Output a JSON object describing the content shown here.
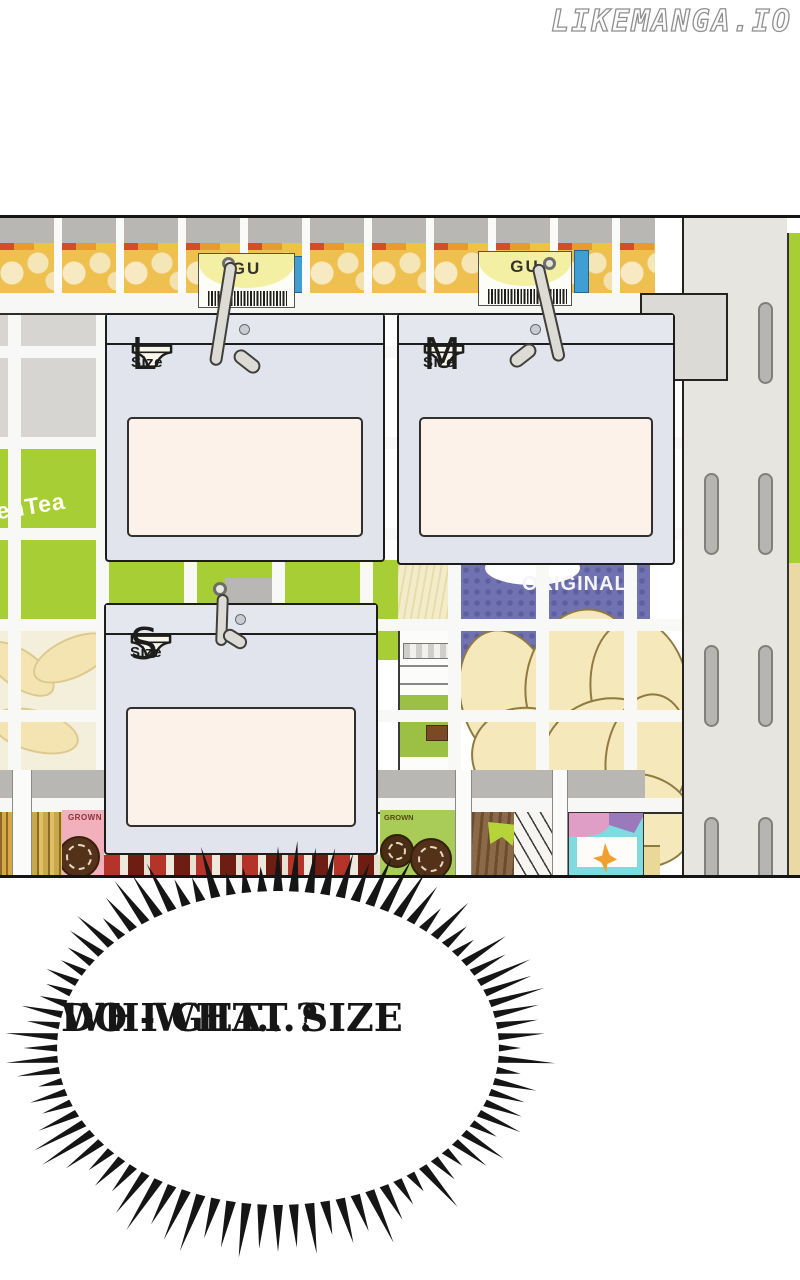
{
  "watermark": {
    "text": "LIKEMANGA.IO"
  },
  "panel": {
    "price_tags": [
      {
        "brand": "GU"
      },
      {
        "brand": "GU"
      }
    ],
    "size_signs": [
      {
        "letter": "L",
        "label": "Size"
      },
      {
        "letter": "M",
        "label": "Size"
      },
      {
        "letter": "S",
        "label": "Size"
      }
    ],
    "shelf_texts": {
      "green_tea_pack": "enTea",
      "chips_bag": "ORIGINAL",
      "pink_pack": "GROWN",
      "green_pack": "GROWN"
    }
  },
  "speech_bubble": {
    "line1": "WH-WHAT SIZE",
    "line2": "DO I GET...?"
  },
  "colors": {
    "panel_outline": "#151515",
    "sign_body": "#e1e4ec",
    "sign_blank_panel": "#fcf2e9",
    "tag_yellow": "#f3f0a3",
    "shelf_green": "#a8ce35",
    "chips_bag_purple": "#7173b0",
    "chip_cream": "#f5e8ba",
    "pink_pack": "#f2afbc",
    "spike_black": "#151515"
  }
}
